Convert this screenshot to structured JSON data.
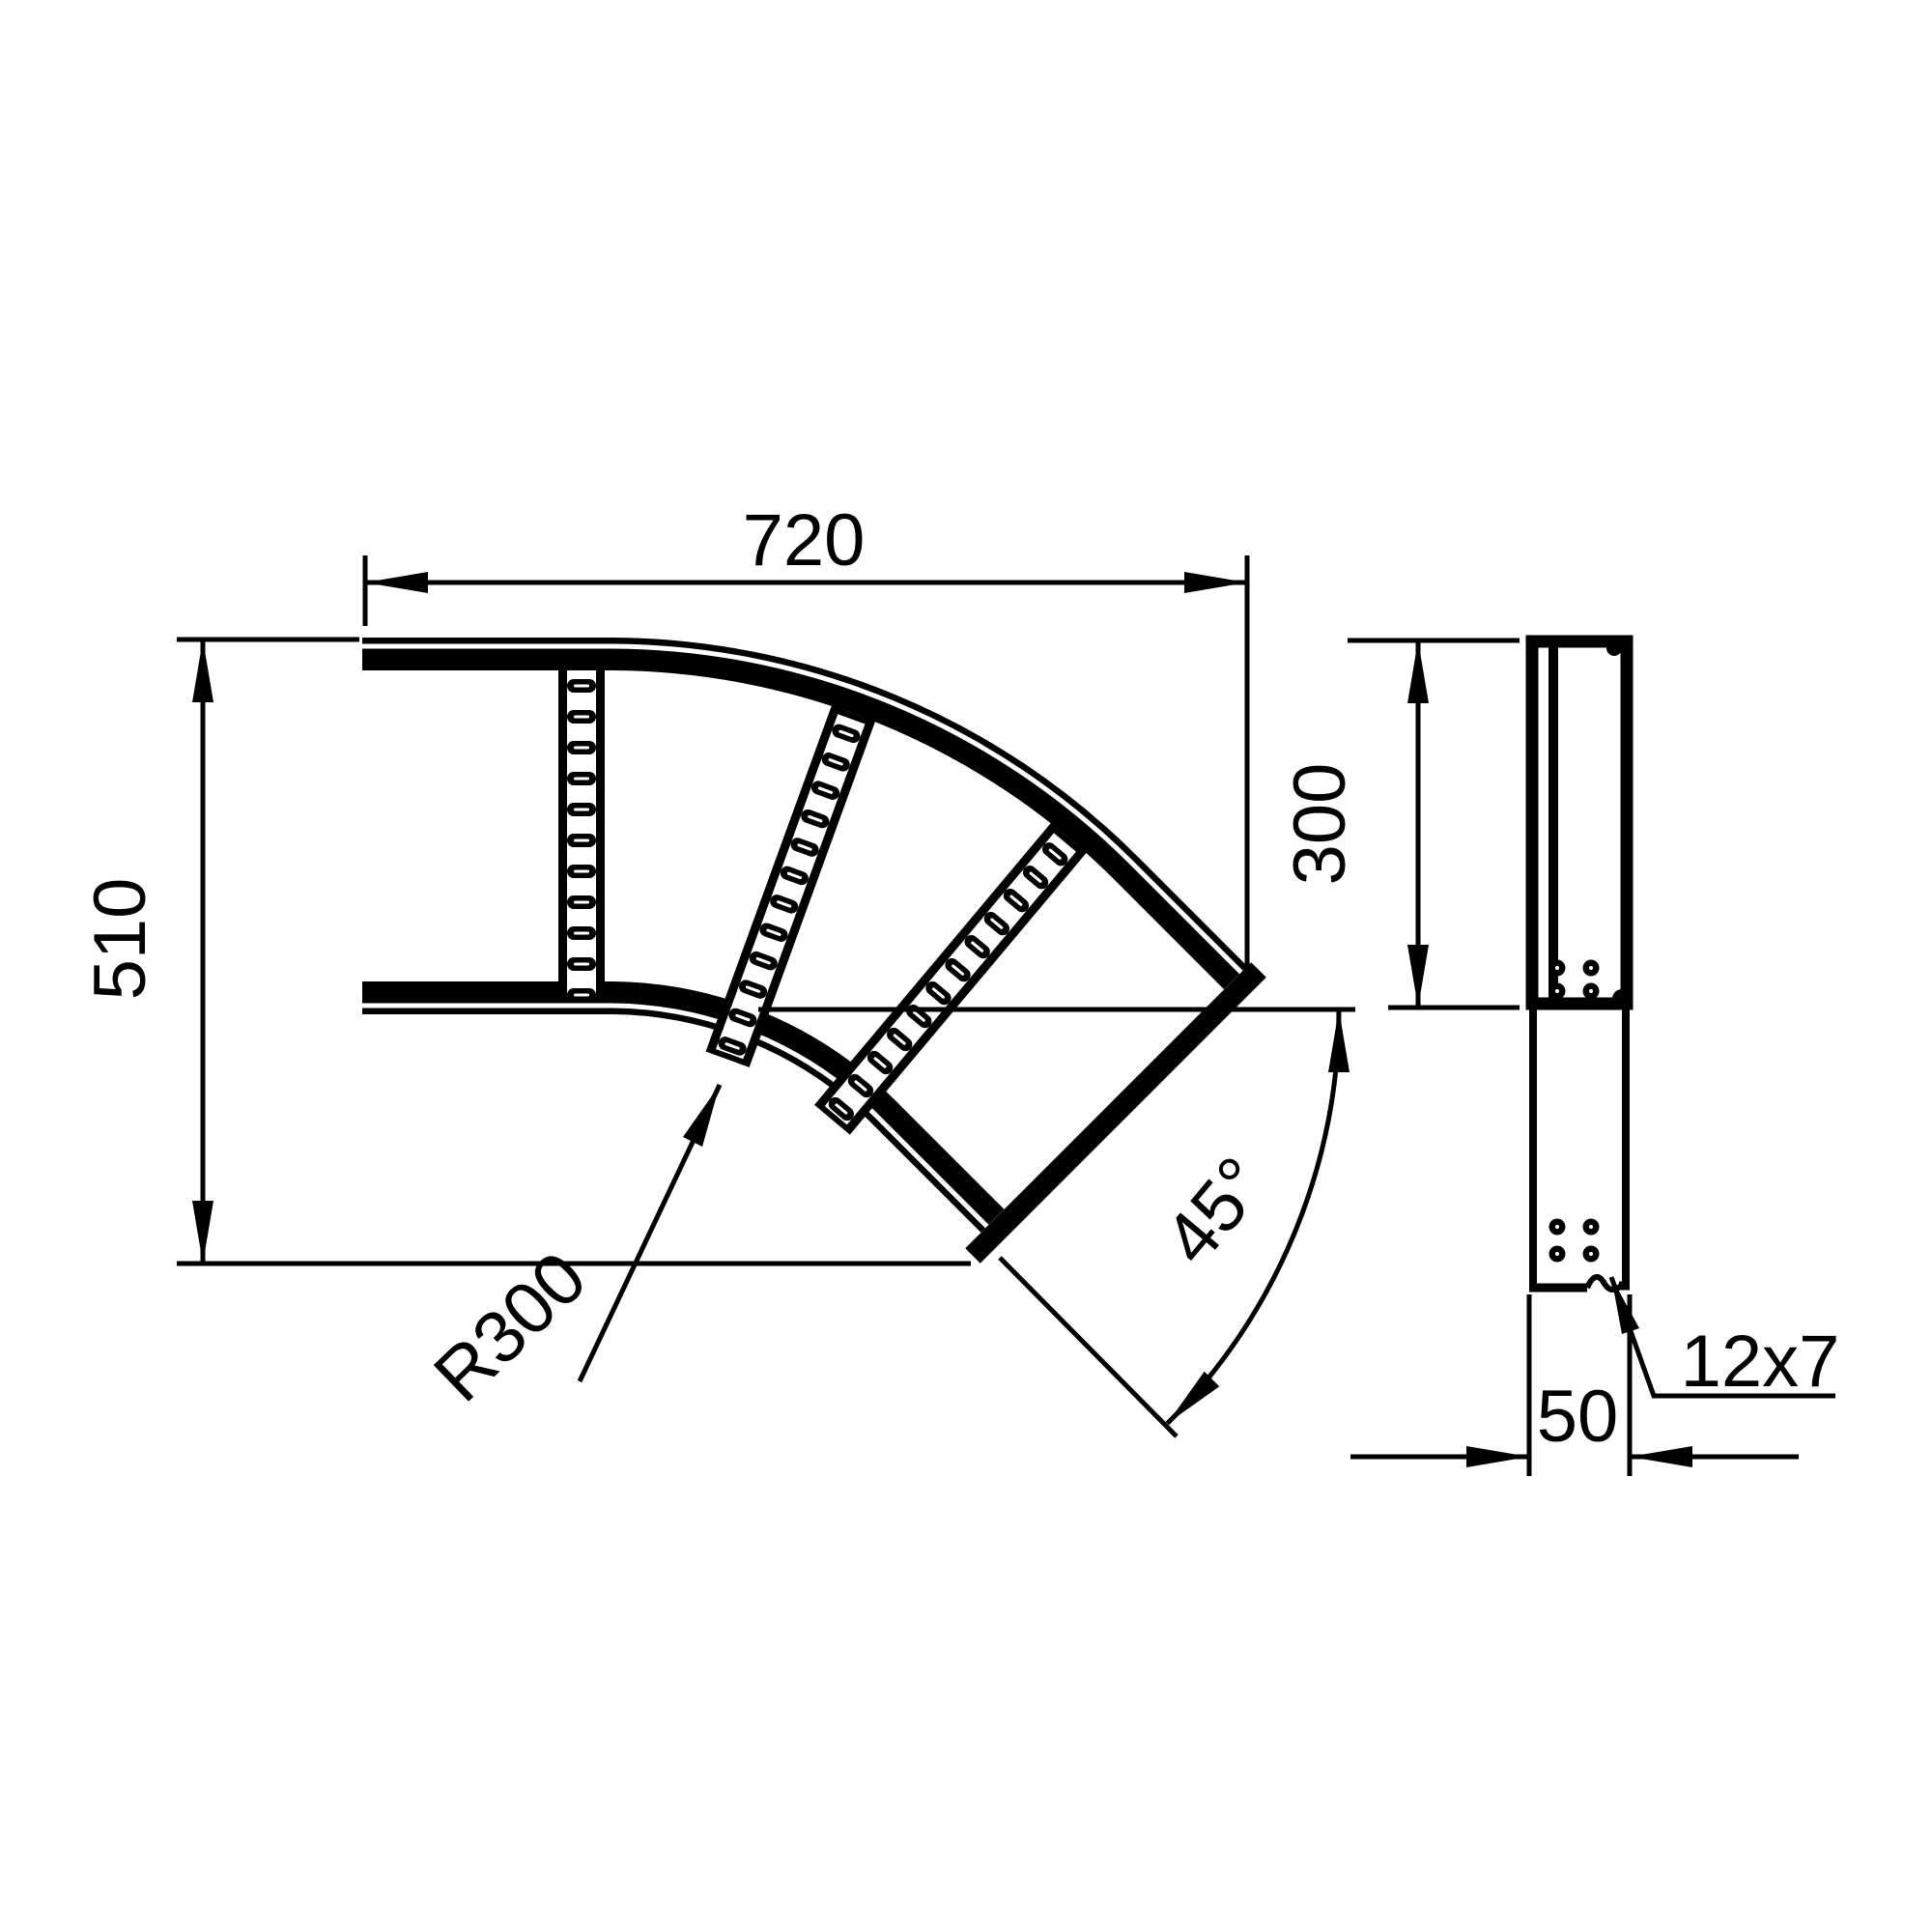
{
  "drawing": {
    "background_color": "#ffffff",
    "line_color": "#000000",
    "main_view": {
      "width_label": "720",
      "height_label": "510",
      "radius_label": "R300",
      "angle_label": "45°"
    },
    "side_view": {
      "width_label": "300",
      "depth_label": "50",
      "slot_label": "12x7"
    }
  }
}
